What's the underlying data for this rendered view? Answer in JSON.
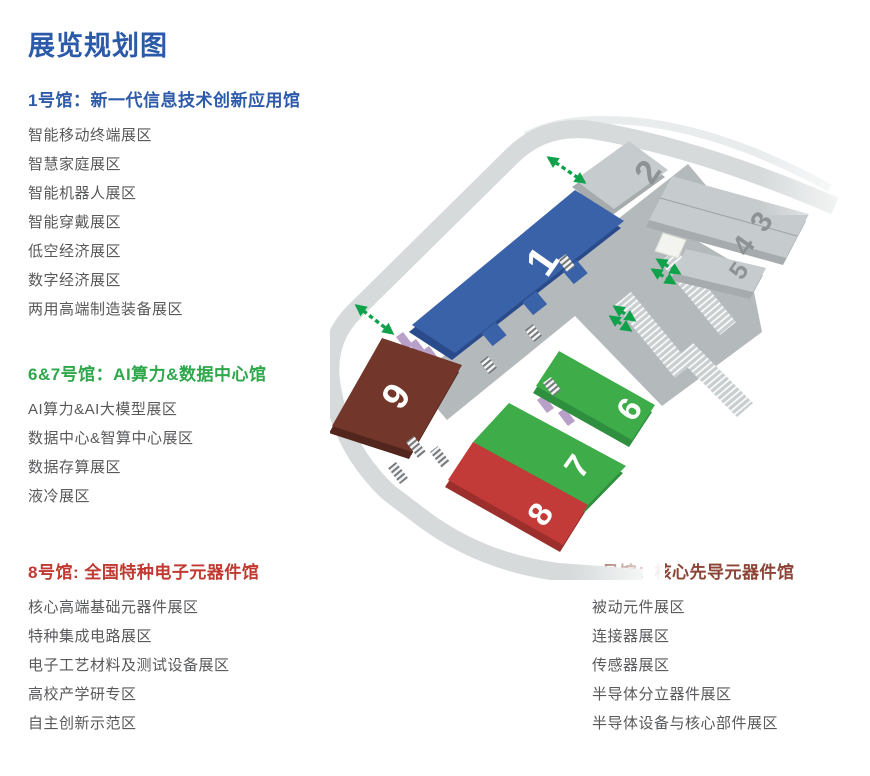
{
  "title": {
    "text": "展览规划图",
    "color": "#2B5AA9"
  },
  "sections": [
    {
      "id": "hall-1",
      "heading": "1号馆：新一代信息技术创新应用馆",
      "color": "#2E5BA9",
      "items": [
        "智能移动终端展区",
        "智慧家庭展区",
        "智能机器人展区",
        "智能穿戴展区",
        "低空经济展区",
        "数字经济展区",
        "两用高端制造装备展区"
      ]
    },
    {
      "id": "hall-6-7",
      "heading": "6&7号馆：AI算力&数据中心馆",
      "color": "#2EA84B",
      "items": [
        "AI算力&AI大模型展区",
        "数据中心&智算中心展区",
        "数据存算展区",
        "液冷展区"
      ]
    },
    {
      "id": "hall-8",
      "heading": "8号馆: 全国特种电子元器件馆",
      "color": "#C13931",
      "items": [
        "核心高端基础元器件展区",
        "特种集成电路展区",
        "电子工艺材料及测试设备展区",
        "高校产学研专区",
        "自主创新示范区"
      ]
    },
    {
      "id": "hall-9",
      "heading": "9号馆：核心先导元器件馆",
      "color": "#8C4437",
      "items": [
        "被动元件展区",
        "连接器展区",
        "传感器展区",
        "半导体分立器件展区",
        "半导体设备与核心部件展区"
      ]
    }
  ],
  "map": {
    "halls": [
      {
        "label": "1",
        "color": "#3A62A8"
      },
      {
        "label": "2",
        "color": "#C6CBCD"
      },
      {
        "label": "3",
        "color": "#C6CBCD"
      },
      {
        "label": "4",
        "color": "#C6CBCD"
      },
      {
        "label": "5",
        "color": "#C6CBCD"
      },
      {
        "label": "6",
        "color": "#3EAC49"
      },
      {
        "label": "7",
        "color": "#3EAC49"
      },
      {
        "label": "8",
        "color": "#C23B38"
      },
      {
        "label": "9",
        "color": "#73362A"
      }
    ],
    "colors": {
      "walkway_purple": "#B9A0C9",
      "arrow_green": "#0FA24B",
      "road_gray": "#D6DADB",
      "concourse_gray": "#B4B9BB"
    }
  }
}
